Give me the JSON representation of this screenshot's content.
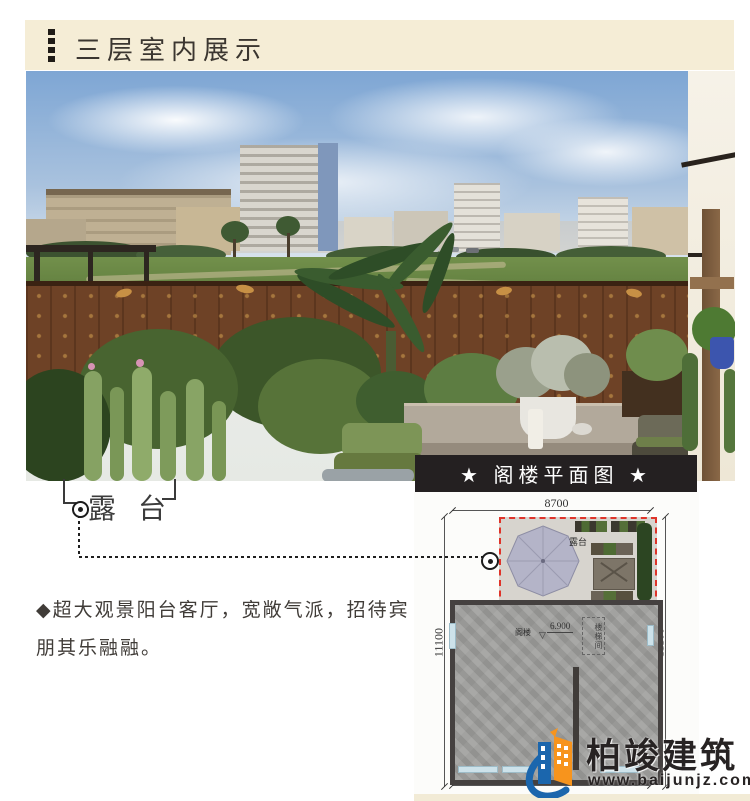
{
  "header": {
    "title": "三层室内展示"
  },
  "annotation": {
    "label": "露台"
  },
  "description": {
    "line1": "◆超大观景阳台客厅，宽敞气派，招待宾",
    "line2": "朋其乐融融。"
  },
  "floorplan": {
    "title": "★ 阁楼平面图 ★",
    "dim_top": "8700",
    "dim_left": "11100",
    "dim_right": "11100",
    "terrace_label": "露台",
    "room_label": "阁楼",
    "elevation": "6.900",
    "elevation_mark": "▽",
    "stair_label": "楼梯间"
  },
  "logo": {
    "brand": "柏竣建筑",
    "website": "www.baijunjz.com"
  },
  "colors": {
    "header_bg": "#f5edd6",
    "accent_red": "#df342a",
    "titlebar_bg": "#242021",
    "logo_blue": "#1b66ad",
    "logo_orange": "#f7941d",
    "umbrella": "#b4b4c8"
  }
}
